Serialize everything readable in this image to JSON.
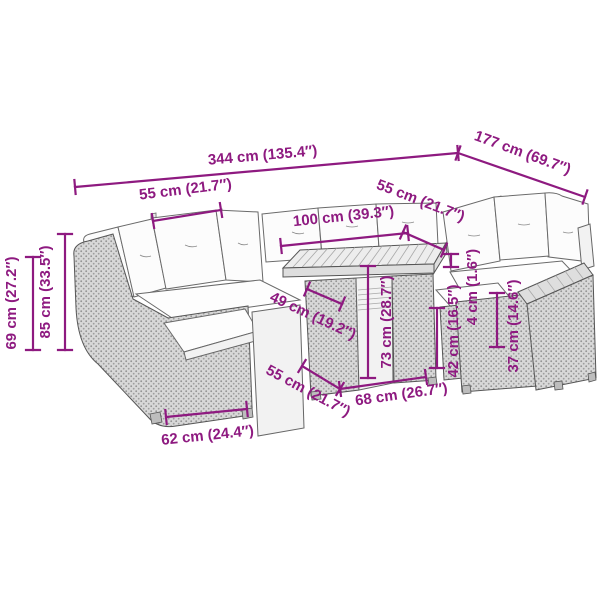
{
  "diagram": {
    "type": "furniture-dimension-drawing",
    "subject": "garden-lounge-set-with-table",
    "background_color": "#ffffff",
    "accent_color": "#8e1a80",
    "outline_color": "#4a4a4a",
    "dimensions": [
      {
        "id": "total-width",
        "label": "344 cm (135.4″)",
        "x1": 75,
        "y1": 187,
        "x2": 458,
        "y2": 153,
        "lx": 263,
        "ly": 160,
        "rot": -5
      },
      {
        "id": "total-depth",
        "label": "177 cm (69.7″)",
        "x1": 458,
        "y1": 153,
        "x2": 585,
        "y2": 197,
        "lx": 521,
        "ly": 157,
        "rot": 20
      },
      {
        "id": "seat-width-back-left",
        "label": "55 cm (21.7″)",
        "x1": 153,
        "y1": 221,
        "x2": 221,
        "y2": 210,
        "lx": 186,
        "ly": 194,
        "rot": -7
      },
      {
        "id": "seat-width-right",
        "label": "55 cm (21.7″)",
        "x1": 403,
        "y1": 232,
        "x2": 444,
        "y2": 250,
        "lx": 419,
        "ly": 205,
        "rot": 21
      },
      {
        "id": "table-length",
        "label": "100 cm (39.3″)",
        "x1": 281,
        "y1": 246,
        "x2": 408,
        "y2": 233,
        "lx": 344,
        "ly": 221,
        "rot": -6
      },
      {
        "id": "seat-depth",
        "label": "49 cm (19.2″)",
        "x1": 307,
        "y1": 289,
        "x2": 342,
        "y2": 304,
        "lx": 311,
        "ly": 320,
        "rot": 25
      },
      {
        "id": "table-height",
        "label": "73 cm (28.7″)",
        "x1": 368,
        "y1": 266,
        "x2": 368,
        "y2": 378,
        "lx": 391,
        "ly": 322,
        "rot": -90
      },
      {
        "id": "seat-height",
        "label": "42 cm (16.5″)",
        "x1": 437,
        "y1": 308,
        "x2": 437,
        "y2": 368,
        "lx": 458,
        "ly": 331,
        "rot": -90
      },
      {
        "id": "cushion-thickness",
        "label": "4 cm (1.6″)",
        "x1": 451,
        "y1": 254,
        "x2": 451,
        "y2": 267,
        "lx": 477,
        "ly": 287,
        "rot": -90
      },
      {
        "id": "frame-seat-height",
        "label": "37 cm (14.6″)",
        "x1": 497,
        "y1": 293,
        "x2": 497,
        "y2": 347,
        "lx": 518,
        "ly": 326,
        "rot": -90
      },
      {
        "id": "back-height",
        "label": "85 cm (33.5″)",
        "x1": 65,
        "y1": 234,
        "x2": 65,
        "y2": 350,
        "lx": 50,
        "ly": 292,
        "rot": -90
      },
      {
        "id": "arm-height",
        "label": "69 cm (27.2″)",
        "x1": 33,
        "y1": 257,
        "x2": 33,
        "y2": 350,
        "lx": 16,
        "ly": 303,
        "rot": -90
      },
      {
        "id": "table-depth",
        "label": "68 cm (26.7″)",
        "x1": 340,
        "y1": 389,
        "x2": 426,
        "y2": 377,
        "lx": 402,
        "ly": 399,
        "rot": -8
      },
      {
        "id": "seat-width-front",
        "label": "55 cm (21.7″)",
        "x1": 302,
        "y1": 366,
        "x2": 340,
        "y2": 389,
        "lx": 306,
        "ly": 395,
        "rot": 28
      },
      {
        "id": "module-width",
        "label": "62 cm (24.4″)",
        "x1": 166,
        "y1": 417,
        "x2": 247,
        "y2": 409,
        "lx": 208,
        "ly": 440,
        "rot": -6
      }
    ]
  }
}
